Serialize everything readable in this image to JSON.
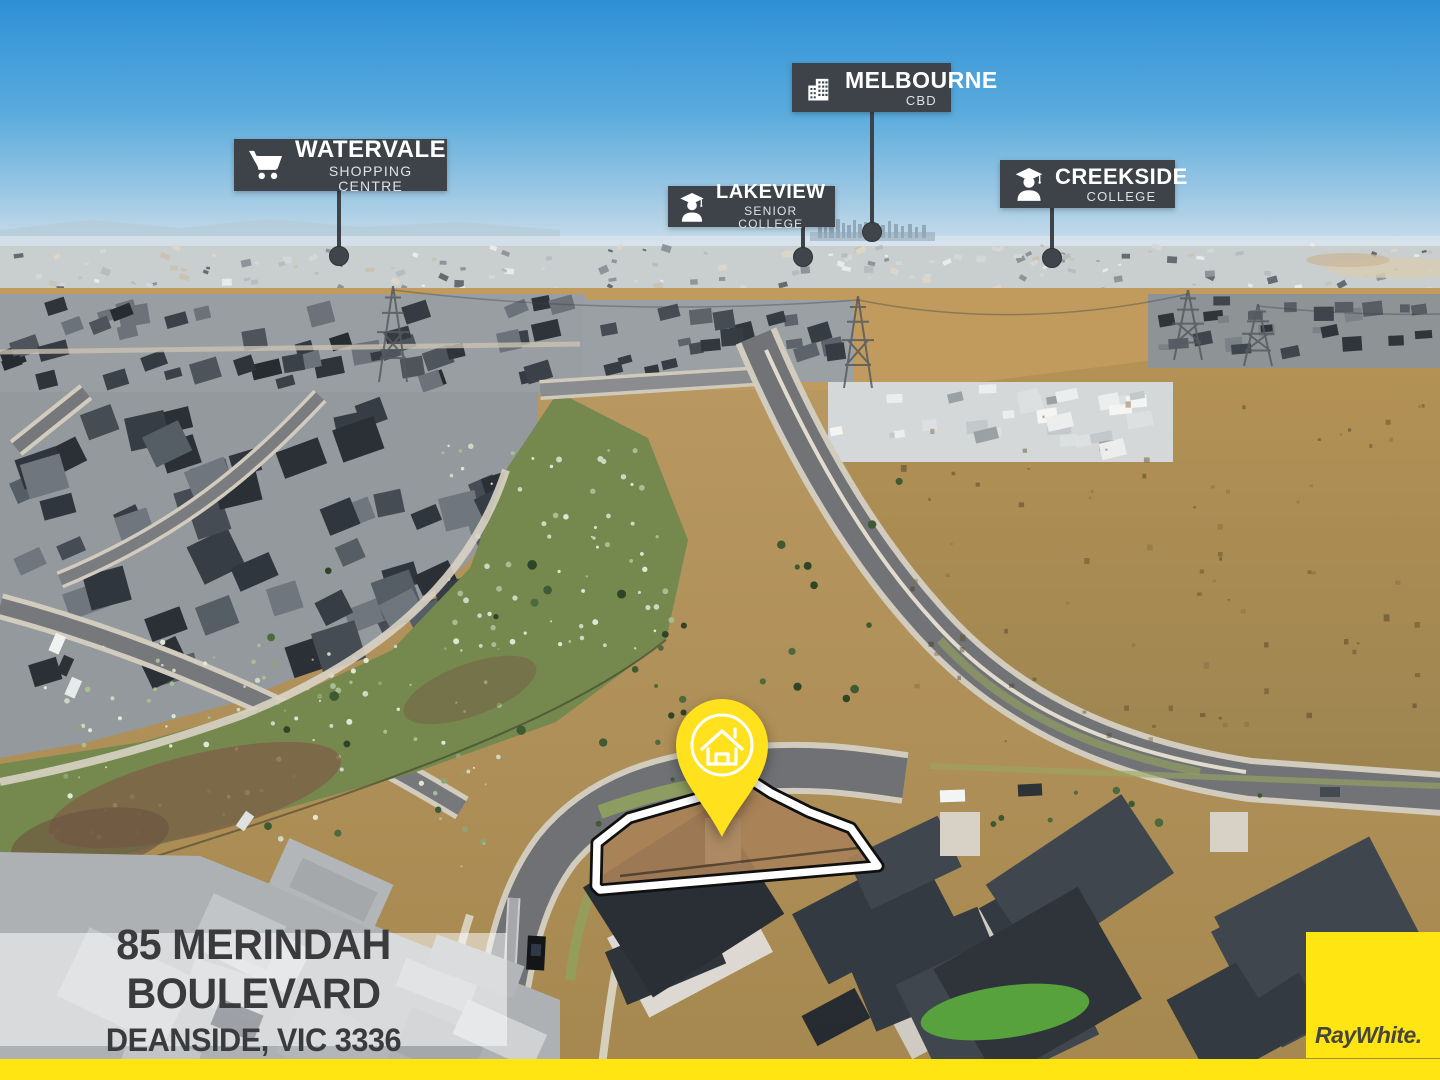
{
  "callouts": {
    "melbourne": {
      "title": "MELBOURNE",
      "subtitle": "CBD",
      "icon": "building-icon"
    },
    "watervale": {
      "title": "WATERVALE",
      "subtitle": "SHOPPING CENTRE",
      "icon": "shopping-cart-icon"
    },
    "lakeview": {
      "title": "LAKEVIEW",
      "subtitle": "SENIOR COLLEGE",
      "icon": "graduate-icon"
    },
    "creekside": {
      "title": "CREEKSIDE",
      "subtitle": "COLLEGE",
      "icon": "graduate-icon"
    }
  },
  "address": {
    "line1": "85 MERINDAH BOULEVARD",
    "line2": "DEANSIDE, VIC 3336"
  },
  "brand": {
    "logo_text": "RayWhite."
  },
  "map_pin": {
    "icon": "house-icon"
  },
  "colors": {
    "accent_yellow": "#ffe512",
    "pin_yellow": "#ffe11e",
    "callout_bg": "#3d4348",
    "address_text": "#3b3b3d",
    "sky_top": "#2e90d5"
  }
}
